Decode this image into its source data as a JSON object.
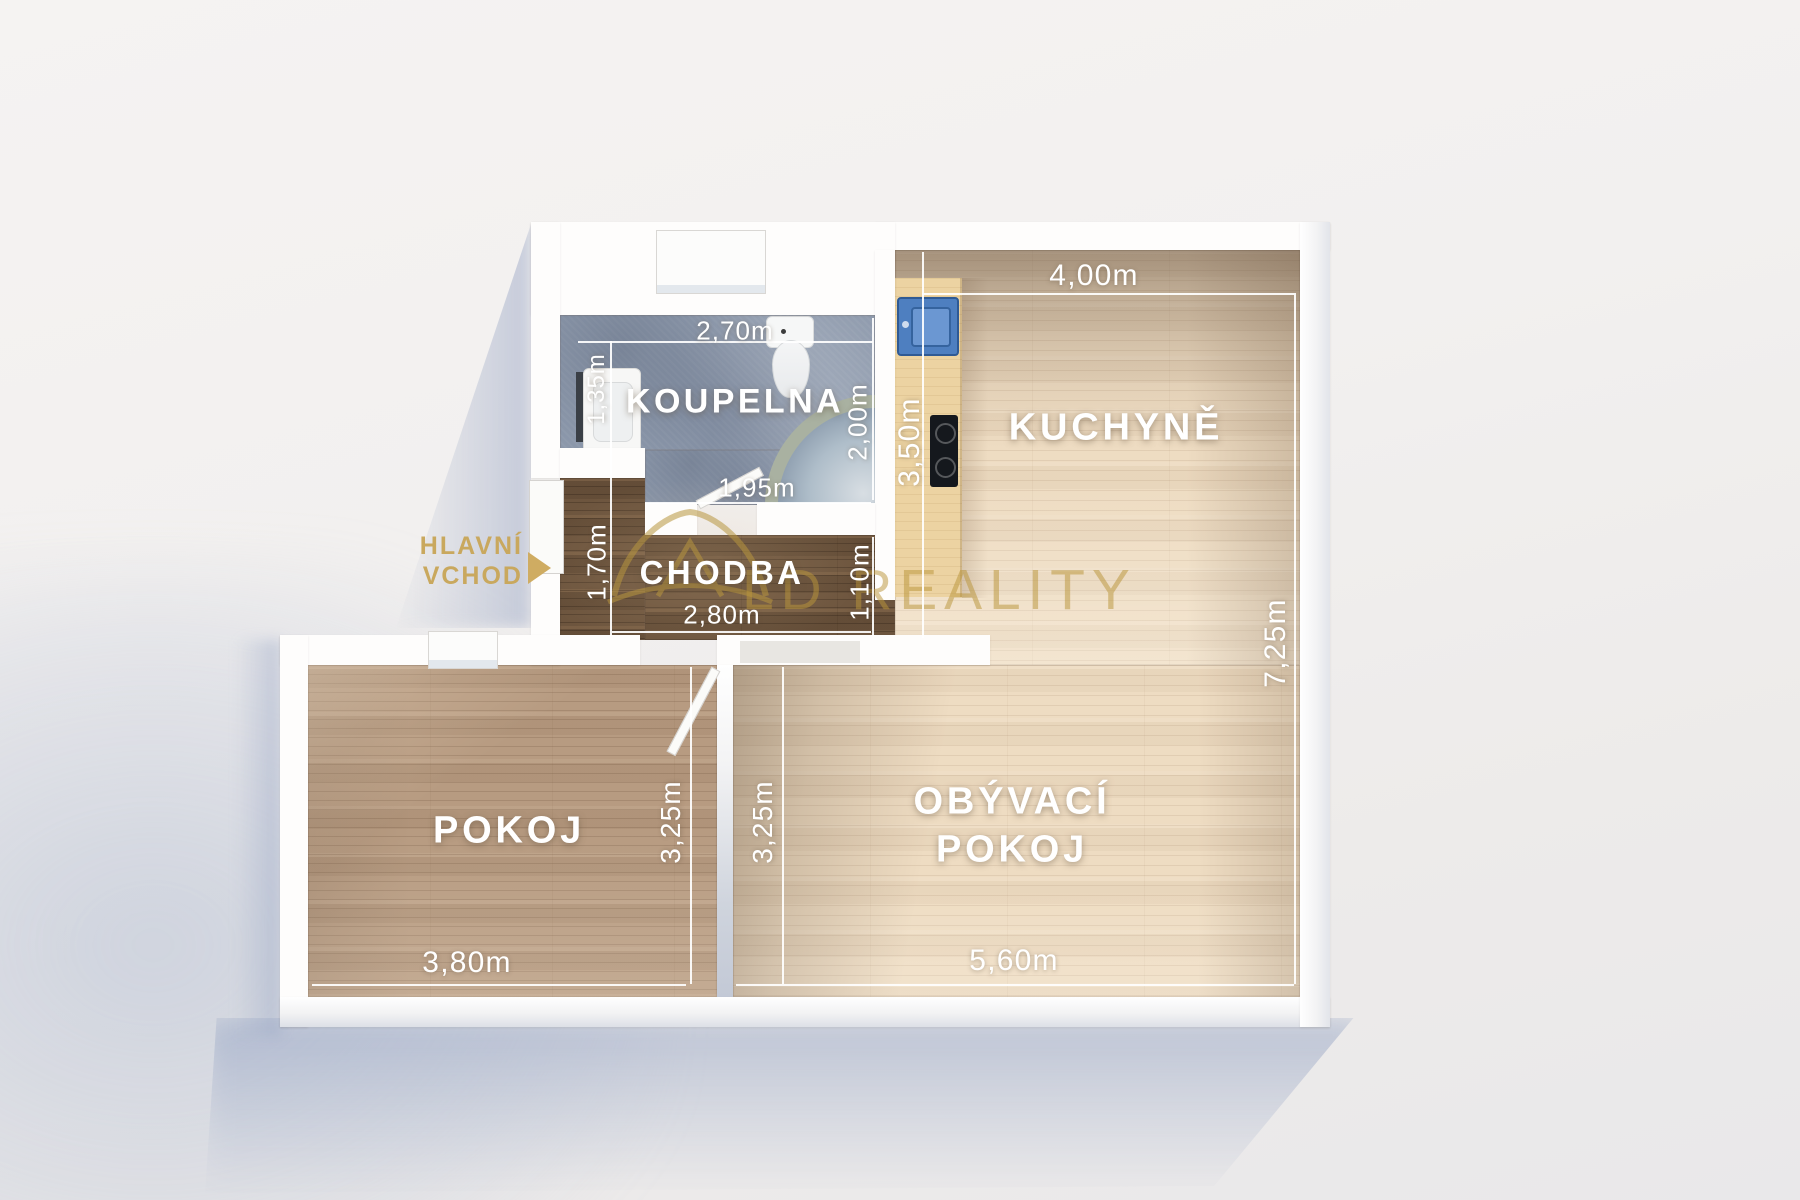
{
  "watermark": {
    "brand": "LD REALITY"
  },
  "entrance": {
    "line1": "HLAVNÍ",
    "line2": "VCHOD"
  },
  "rooms": {
    "koupelna": {
      "label": "KOUPELNA",
      "dims": {
        "width": "2,70m",
        "niche": "1,35m",
        "depth": "2,00m",
        "door": "1,95m"
      }
    },
    "kuchyne": {
      "label": "KUCHYNĚ",
      "dims": {
        "width": "4,00m",
        "counter_wall": "3,50m"
      }
    },
    "chodba": {
      "label": "CHODBA",
      "dims": {
        "left": "1,70m",
        "right": "1,10m",
        "width": "2,80m"
      }
    },
    "pokoj": {
      "label": "POKOJ",
      "dims": {
        "depth": "3,25m",
        "width": "3,80m"
      }
    },
    "obyvaci": {
      "label_line1": "OBÝVACÍ",
      "label_line2": "POKOJ",
      "dims": {
        "depth": "3,25m",
        "width": "5,60m",
        "right_wall": "7,25m"
      }
    }
  },
  "colors": {
    "accent_gold": "#c9a85e",
    "wall_white": "#fefdfc",
    "floor_light_wood": "#eedcc2",
    "floor_medium_wood": "#b79b81",
    "floor_dark_wood": "#6d553e",
    "floor_tile_blue": "#8c98ab",
    "dimension_text": "#ffffff",
    "kitchen_sink_blue": "#4e7fc0",
    "shadow_blue": "#9aaac8"
  }
}
